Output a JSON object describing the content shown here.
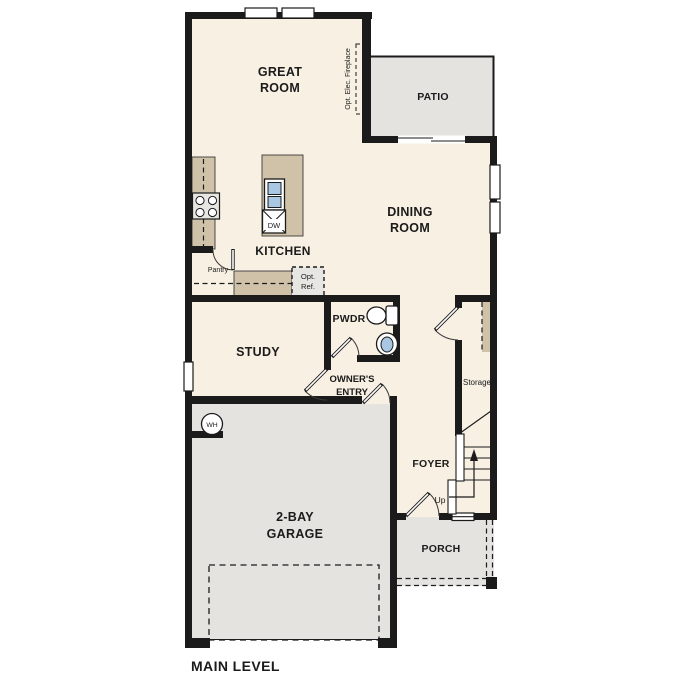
{
  "plan": {
    "title": "MAIN LEVEL",
    "rooms": {
      "great_room": {
        "line1": "GREAT",
        "line2": "ROOM"
      },
      "patio": {
        "label": "PATIO"
      },
      "kitchen": {
        "label": "KITCHEN",
        "pantry": "Pantry",
        "opt_ref_line1": "Opt.",
        "opt_ref_line2": "Ref.",
        "dishwasher": "DW"
      },
      "dining_room": {
        "line1": "DINING",
        "line2": "ROOM"
      },
      "study": {
        "label": "STUDY"
      },
      "powder_room": {
        "label": "PWDR"
      },
      "owners_entry": {
        "line1": "OWNER'S",
        "line2": "ENTRY"
      },
      "foyer": {
        "label": "FOYER",
        "stairs_up": "Up"
      },
      "storage": {
        "label": "Storage"
      },
      "porch": {
        "label": "PORCH"
      },
      "garage": {
        "line1": "2-BAY",
        "line2": "GARAGE",
        "water_heater": "WH"
      }
    },
    "annotations": {
      "fireplace": "Opt. Elec. Fireplace"
    },
    "colors": {
      "floor": "#f7f0e3",
      "outdoor_concrete": "#e4e3e0",
      "counter": "#cfc2a8",
      "appliance": "#e7e6e2",
      "sink_fill": "#a9c7e3",
      "wall": "#1b1b1b"
    }
  }
}
